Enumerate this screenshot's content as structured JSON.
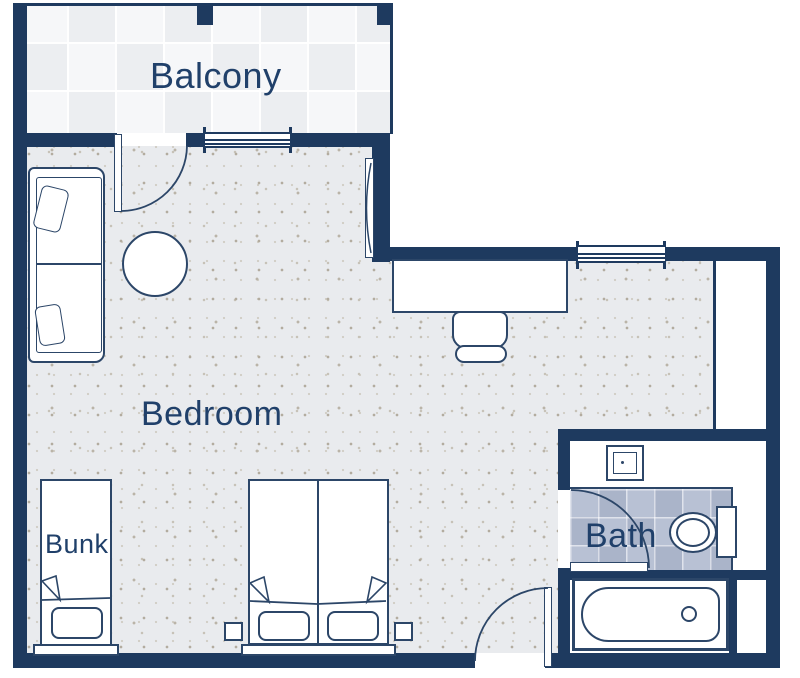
{
  "plan_title": "Hotel room floor plan",
  "rooms": {
    "balcony": {
      "label": "Balcony"
    },
    "bedroom": {
      "label": "Bedroom"
    },
    "bath": {
      "label": "Bath"
    },
    "bunk": {
      "label": "Bunk"
    }
  },
  "furniture": [
    "sofa",
    "coffee-table",
    "wall-mirror",
    "desk",
    "desk-chair",
    "double-bed",
    "bunk-bed",
    "nightstand",
    "sink",
    "toilet",
    "bathtub",
    "closet"
  ],
  "theme": {
    "wall_color": "#1e3a5f",
    "stroke_color": "#2c4668",
    "label_color": "#20406a",
    "floor_color": "#e9ebee",
    "speckle_color": "#b7b1a6",
    "balcony_tile_light": "#f6f7f9",
    "balcony_tile_dark": "#eceef1",
    "bath_tile_light": "#b8c1d4",
    "bath_tile_dark": "#aab4c9",
    "furniture_fill": "#ffffff"
  }
}
